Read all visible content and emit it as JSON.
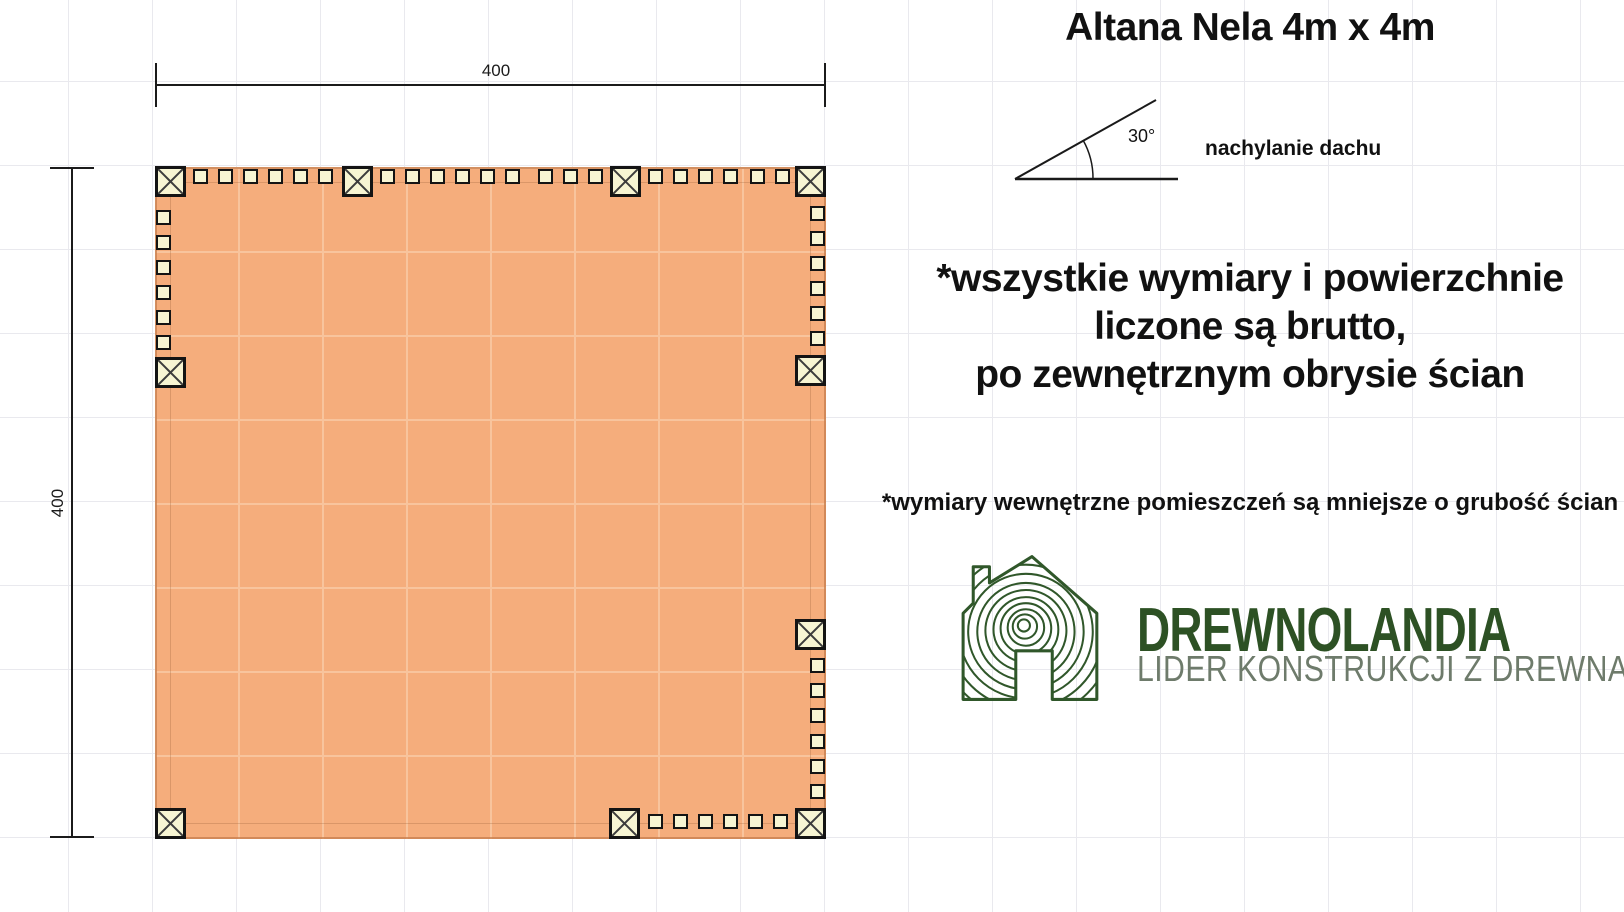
{
  "title": "Altana Nela 4m x 4m",
  "roof": {
    "angle_label": "30°",
    "caption": "nachylanie dachu"
  },
  "plan": {
    "width_label": "400",
    "height_label": "400"
  },
  "notes": {
    "line1": "*wszystkie wymiary i powierzchnie",
    "line2": "liczone są brutto,",
    "line3": "po zewnętrznym obrysie ścian",
    "secondary": "*wymiary wewnętrzne pomieszczeń są mniejsze o grubość ścian"
  },
  "logo": {
    "name": "DREWNOLANDIA",
    "tagline": "LIDER KONSTRUKCJI Z DREWNA"
  },
  "colors": {
    "plan_fill": "#f5ad7c",
    "plan_grid": "#f8c49d",
    "wood_cream": "#f7f5d3",
    "grid_line": "#e9e9ee",
    "logo_green": "#2d5124",
    "logo_gray": "#6e7b6b"
  }
}
